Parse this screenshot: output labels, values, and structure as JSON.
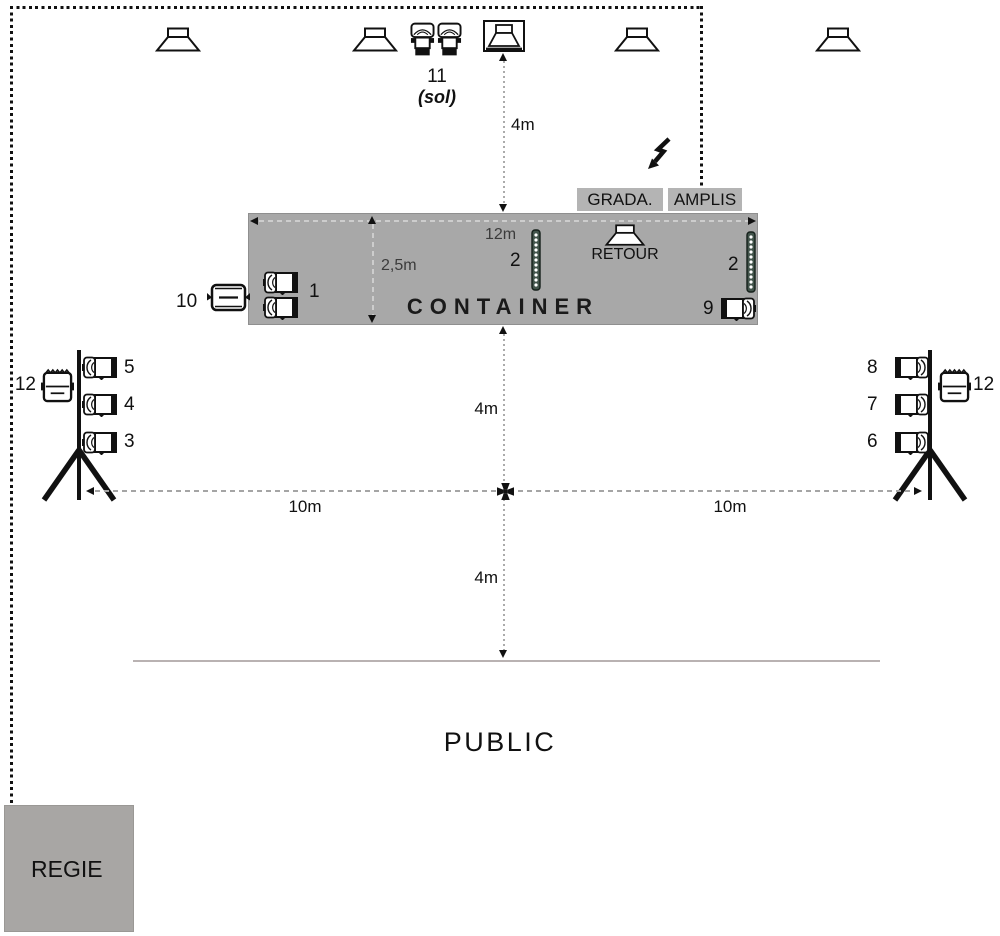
{
  "colors": {
    "container_fill": "#a8a8a8",
    "container_border": "#8f8f8f",
    "label_box_fill": "#b4b4b4",
    "regie_fill": "#a8a6a4",
    "led_strip_fill": "#42544b",
    "dash_on_white": "#a5a5a5",
    "dash_on_gray": "#cdcdcd",
    "ground_line": "#b9b2b2"
  },
  "top_cluster": {
    "fixture_label": "11",
    "fixture_sublabel": "(sol)"
  },
  "power": {
    "grada_label": "GRADA.",
    "amplis_label": "AMPLIS"
  },
  "stage": {
    "title": "CONTAINER",
    "monitor_label": "RETOUR",
    "width_label": "12m",
    "depth_label": "2,5m",
    "led_left_label": "2",
    "led_right_label": "2",
    "par_pair_label": "1",
    "par_side_label": "9",
    "blinder_label": "10"
  },
  "distances": {
    "speakers_to_stage": "4m",
    "stage_to_cross": "4m",
    "cross_to_front": "4m",
    "left_span": "10m",
    "right_span": "10m"
  },
  "left_tower": {
    "par_labels": [
      "5",
      "4",
      "3"
    ],
    "flood_label": "12"
  },
  "right_tower": {
    "par_labels": [
      "8",
      "7",
      "6"
    ],
    "flood_label": "12"
  },
  "audience_label": "PUBLIC",
  "booth_label": "REGIE"
}
